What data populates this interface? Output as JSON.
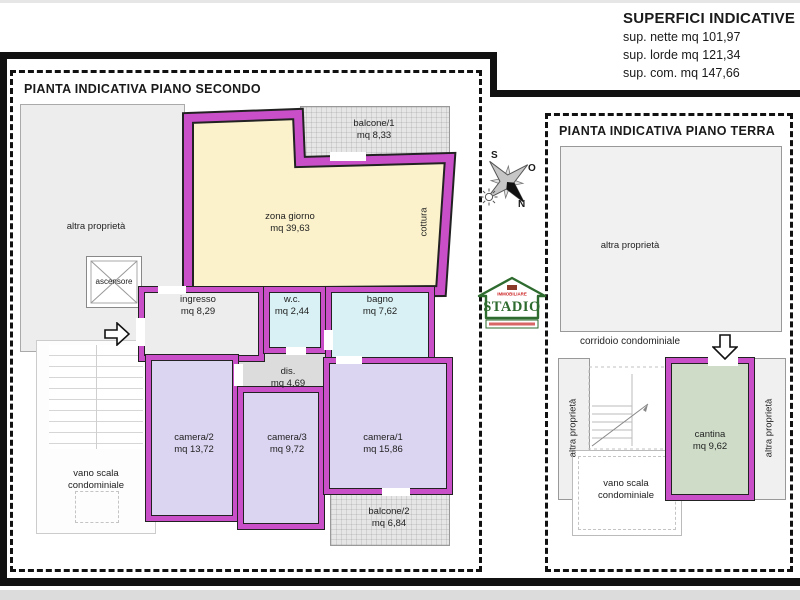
{
  "header": {
    "title": "SUPERFICI INDICATIVE",
    "nette": "sup. nette mq 101,97",
    "lorde": "sup. lorde mq 121,34",
    "com": "sup. com. mq 147,66"
  },
  "floor2": {
    "title": "PIANTA INDICATIVA PIANO SECONDO",
    "balcone1": {
      "name": "balcone/1",
      "area": "mq 8,33"
    },
    "zona_giorno": {
      "name": "zona giorno",
      "area": "mq 39,63"
    },
    "cottura": "cottura",
    "altra_proprieta": "altra proprietà",
    "ascensore": "ascensore",
    "ingresso": {
      "name": "ingresso",
      "area": "mq 8,29"
    },
    "wc": {
      "name": "w.c.",
      "area": "mq 2,44"
    },
    "bagno": {
      "name": "bagno",
      "area": "mq 7,62"
    },
    "dis": {
      "name": "dis.",
      "area": "mq 4,69"
    },
    "camera2": {
      "name": "camera/2",
      "area": "mq 13,72"
    },
    "camera3": {
      "name": "camera/3",
      "area": "mq 9,72"
    },
    "camera1": {
      "name": "camera/1",
      "area": "mq 15,86"
    },
    "balcone2": {
      "name": "balcone/2",
      "area": "mq 6,84"
    },
    "vano_scala": "vano scala condominiale"
  },
  "floor0": {
    "title": "PIANTA INDICATIVA PIANO TERRA",
    "altra_proprieta_top": "altra proprietà",
    "corridoio": "corridoio condominiale",
    "altra_proprieta_sx": "altra proprietà",
    "altra_proprieta_dx": "altra proprietà",
    "cantina": {
      "name": "cantina",
      "area": "mq 9,62"
    },
    "vano_scala": "vano scala condominiale"
  },
  "compass": {
    "s": "S",
    "o": "O",
    "n": "N"
  },
  "logo": {
    "brand_top": "IMMOBILIARE",
    "brand": "STADIO"
  },
  "colors": {
    "wall": "#c94fc9",
    "zona_giorno": "#fbf2cb",
    "bagni": "#d9f1f4",
    "camere": "#dcd5f1",
    "cantina": "#cfddc8",
    "balconi": "#e6e6e6",
    "altra_proprieta": "#ededed",
    "logo_green": "#2e6b2e",
    "logo_red": "#cc2222"
  }
}
